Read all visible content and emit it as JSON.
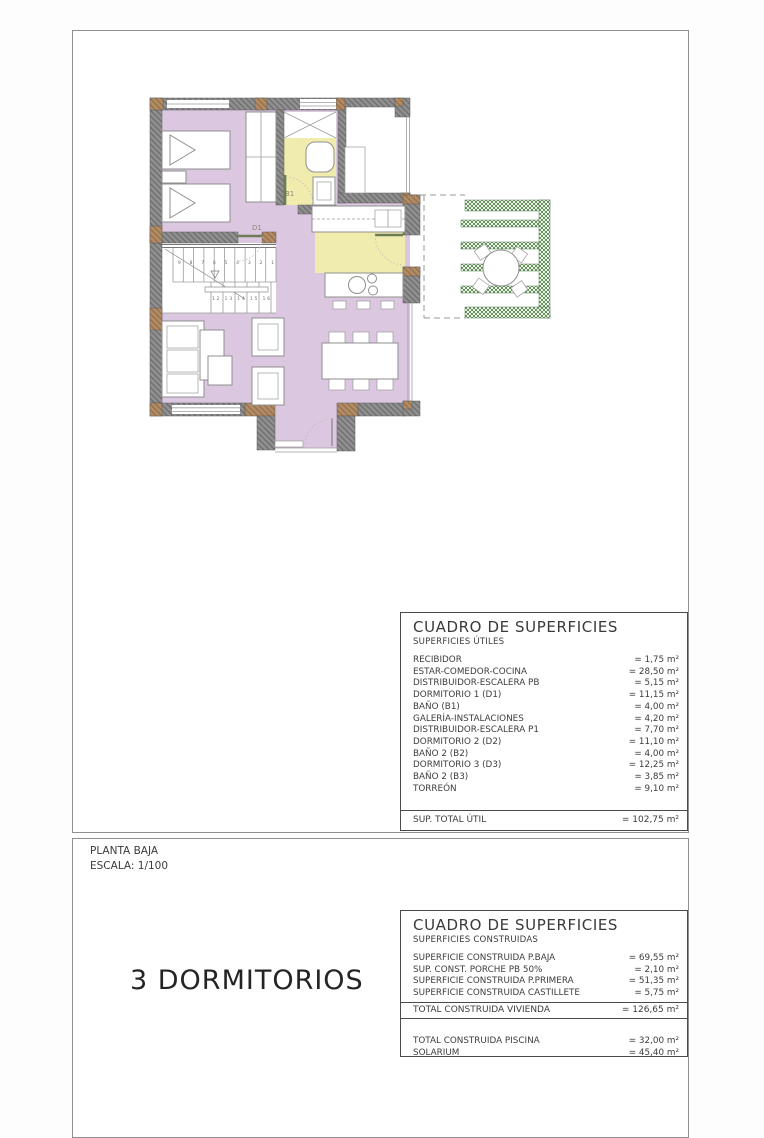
{
  "plan": {
    "labels": {
      "b1": "B1",
      "d1": "D1"
    },
    "stairs": {
      "upper_numbers": "9 8 7 6 5 4 3 2 1",
      "lower_numbers": "12 13 14 15 16"
    }
  },
  "titleblock": {
    "planta": "PLANTA BAJA",
    "escala": "ESCALA: 1/100",
    "dormitorios": "3 DORMITORIOS"
  },
  "tables": {
    "utiles": {
      "title": "CUADRO DE SUPERFICIES",
      "subtitle": "SUPERFICIES ÚTILES",
      "rows": [
        {
          "label": "RECIBIDOR",
          "value": "= 1,75 m²"
        },
        {
          "label": "ESTAR-COMEDOR-COCINA",
          "value": "= 28,50 m²"
        },
        {
          "label": "DISTRIBUIDOR-ESCALERA PB",
          "value": "= 5,15 m²"
        },
        {
          "label": "DORMITORIO 1 (D1)",
          "value": "= 11,15 m²"
        },
        {
          "label": "BAÑO (B1)",
          "value": "= 4,00 m²"
        },
        {
          "label": "GALERÍA-INSTALACIONES",
          "value": "= 4,20 m²"
        },
        {
          "label": "DISTRIBUIDOR-ESCALERA P1",
          "value": "= 7,70 m²"
        },
        {
          "label": "DORMITORIO 2 (D2)",
          "value": "= 11,10 m²"
        },
        {
          "label": "BAÑO 2 (B2)",
          "value": "= 4,00 m²"
        },
        {
          "label": "DORMITORIO 3 (D3)",
          "value": "= 12,25 m²"
        },
        {
          "label": "BAÑO 2 (B3)",
          "value": "= 3,85 m²"
        },
        {
          "label": "TORREÓN",
          "value": "= 9,10 m²"
        }
      ],
      "total": {
        "label": "SUP. TOTAL ÚTIL",
        "value": "= 102,75 m²"
      }
    },
    "construidas": {
      "title": "CUADRO DE SUPERFICIES",
      "subtitle": "SUPERFICIES CONSTRUIDAS",
      "rows": [
        {
          "label": "SUPERFICIE CONSTRUIDA P.BAJA",
          "value": "= 69,55 m²"
        },
        {
          "label": "SUP. CONST. PORCHE PB 50%",
          "value": "= 2,10 m²"
        },
        {
          "label": "SUPERFICIE CONSTRUIDA P.PRIMERA",
          "value": "= 51,35 m²"
        },
        {
          "label": "SUPERFICIE CONSTRUIDA CASTILLETE",
          "value": "= 5,75 m²"
        }
      ],
      "total": {
        "label": "TOTAL CONSTRUIDA VIVIENDA",
        "value": "= 126,65 m²"
      },
      "extra_rows": [
        {
          "label": "TOTAL CONSTRUIDA PISCINA",
          "value": "= 32,00 m²"
        },
        {
          "label": "SOLARIUM",
          "value": "= 45,40 m²"
        }
      ]
    }
  },
  "colors": {
    "floor_purple": "#dbc7e0",
    "floor_yellow": "#f0ecae",
    "terrace_green": "#66935f",
    "wall_gray": "#909090",
    "wall_brown": "#b38c66"
  }
}
